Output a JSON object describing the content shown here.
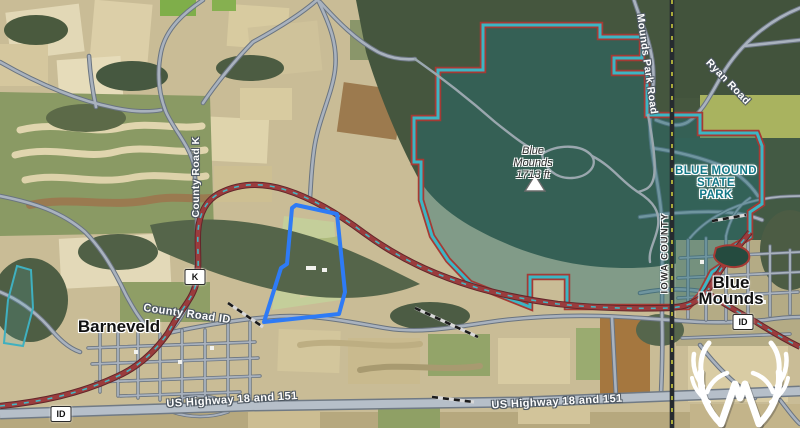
{
  "map_labels": {
    "town_west": "Barneveld",
    "town_east_line1": "Blue",
    "town_east_line2": "Mounds",
    "peak_name_line1": "Blue",
    "peak_name_line2": "Mounds",
    "peak_elevation": "1713 ft",
    "state_park_line1": "BLUE MOUND",
    "state_park_line2": "STATE",
    "state_park_line3": "PARK",
    "road_county_k": "County Road K",
    "road_county_id": "County Road ID",
    "road_us_highway": "US Highway 18 and 151",
    "road_mounds_park": "Mounds Park Road",
    "road_ryan": "Ryan Road",
    "county_line_label": "IOWA COUNTY",
    "shield_k": "K",
    "shield_id": "ID"
  },
  "overlays": {
    "property_boundary": "highlighted listing parcel outline",
    "park_area": "state park boundary overlay",
    "watermark": "whitetail-properties-antler-logo"
  },
  "colors": {
    "property_outline": "#2e7bf6",
    "park_boundary_outer": "#a63a34",
    "park_boundary_inner": "#3cb6c4",
    "park_tint": "#1e6e74",
    "red_road": "#9a3c3d",
    "road_fill": "#a9b2be",
    "highway_fill": "#b6bfc9",
    "county_line_dash": "#c8c93e",
    "park_text": "#127887",
    "logo_color": "#ffffff"
  }
}
